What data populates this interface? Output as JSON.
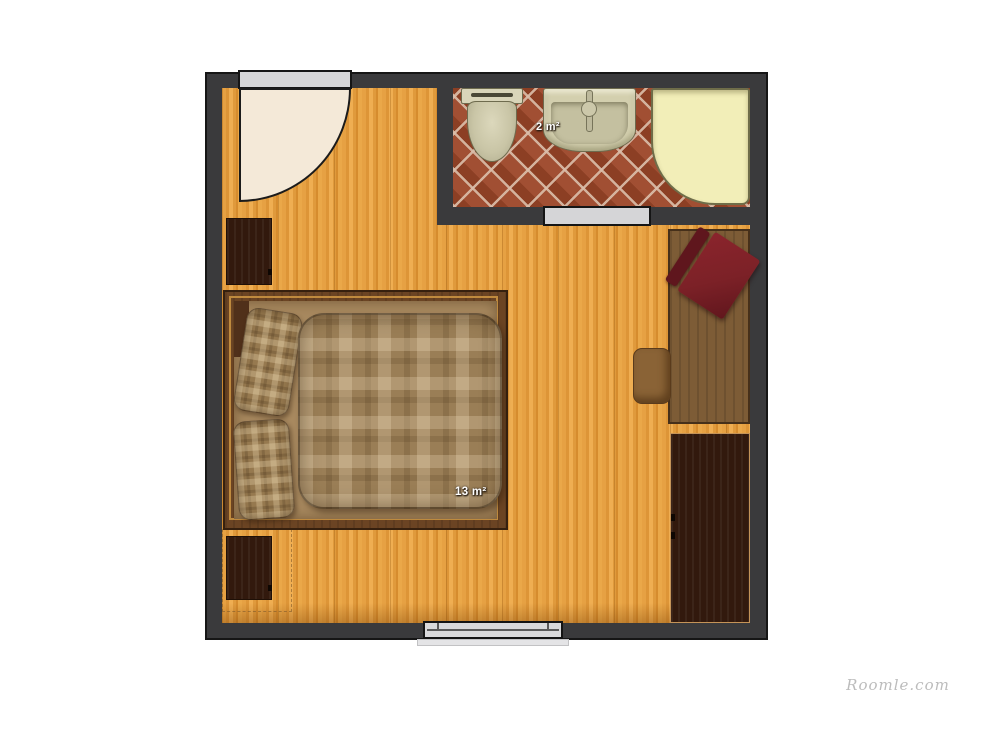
{
  "app": {
    "watermark": "Roomle.com"
  },
  "plan": {
    "type": "floor-plan",
    "rooms": [
      {
        "name": "Bedroom",
        "area_label": "13 m²",
        "floor": "wood planks"
      },
      {
        "name": "Bathroom",
        "area_label": "2 m²",
        "floor": "red diagonal tile"
      }
    ],
    "labels": {
      "bedroom_area": "13 m²",
      "bathroom_area": "2 m²"
    },
    "furniture": [
      "double-bed",
      "pillow-left-top",
      "pillow-left-bottom",
      "plaid-duvet",
      "nightstand-top",
      "nightstand-bottom",
      "desk",
      "red-desk-chair",
      "small-chair",
      "wardrobe",
      "toilet",
      "sink",
      "shower-tray",
      "entry-door",
      "bathroom-door",
      "window"
    ],
    "colors": {
      "wall": "#3a3a3c",
      "floor_wood": "#e29c40",
      "bathroom_tile": "#9c4628",
      "shower_tray": "#f2eeb8",
      "fixtures": "#d3cfae",
      "bed_plaid": "#9a7e56",
      "bed_frame": "#6b4423",
      "dark_wood": "#32190d",
      "desk_wood": "#7d5c36",
      "chair_red": "#7c2127",
      "door_leaf": "#f4e9d8",
      "opening_gray": "#d5d5d7"
    }
  }
}
